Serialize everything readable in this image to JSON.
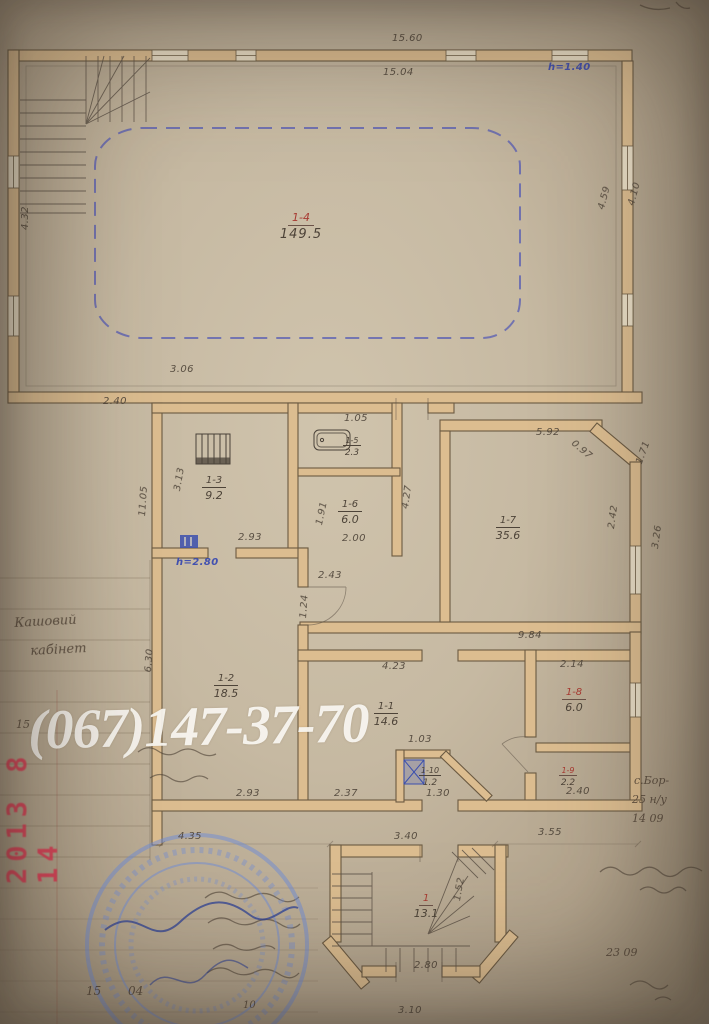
{
  "document": {
    "watermark_phone": "(067)147-37-70",
    "camera_date_stamp": "2013 8 14"
  },
  "plan": {
    "rooms": [
      {
        "id": "1-4",
        "num": "1-4",
        "area": "149.5",
        "x": 308,
        "y": 206,
        "red": true,
        "big": true
      },
      {
        "id": "1-3",
        "num": "1-3",
        "area": "9.2",
        "x": 214,
        "y": 468
      },
      {
        "id": "1-5",
        "num": "1-5",
        "area": "2.3",
        "x": 360,
        "y": 428,
        "small": true
      },
      {
        "id": "1-6",
        "num": "1-6",
        "area": "6.0",
        "x": 350,
        "y": 492
      },
      {
        "id": "1-7",
        "num": "1-7",
        "area": "35.6",
        "x": 508,
        "y": 508
      },
      {
        "id": "1-2",
        "num": "1-2",
        "area": "18.5",
        "x": 226,
        "y": 666
      },
      {
        "id": "1-1",
        "num": "1-1",
        "area": "14.6",
        "x": 386,
        "y": 694
      },
      {
        "id": "1-8",
        "num": "1-8",
        "area": "6.0",
        "x": 574,
        "y": 680,
        "red": true
      },
      {
        "id": "1-9",
        "num": "1-9",
        "area": "2.2",
        "x": 576,
        "y": 758,
        "red": true,
        "small": true
      },
      {
        "id": "1-10",
        "num": "1-10",
        "area": "1.2",
        "x": 438,
        "y": 758,
        "small": true
      },
      {
        "id": "1",
        "num": "1",
        "area": "13.1",
        "x": 426,
        "y": 886,
        "red": true
      }
    ],
    "dimensions": [
      {
        "t": "15.60",
        "x": 392,
        "y": 33
      },
      {
        "t": "15.04",
        "x": 383,
        "y": 67
      },
      {
        "t": "4.32",
        "x": 20,
        "y": 230,
        "r": -90
      },
      {
        "t": "4.59",
        "x": 596,
        "y": 208,
        "r": -75
      },
      {
        "t": "4.10",
        "x": 626,
        "y": 204,
        "r": -75
      },
      {
        "t": "3.06",
        "x": 170,
        "y": 364
      },
      {
        "t": "2.40",
        "x": 103,
        "y": 396
      },
      {
        "t": "1.05",
        "x": 344,
        "y": 413
      },
      {
        "t": "3.13",
        "x": 172,
        "y": 490,
        "r": -80
      },
      {
        "t": "11.05",
        "x": 137,
        "y": 516,
        "r": -86
      },
      {
        "t": "2.93",
        "x": 238,
        "y": 532
      },
      {
        "t": "1.91",
        "x": 314,
        "y": 524,
        "r": -78
      },
      {
        "t": "2.00",
        "x": 342,
        "y": 533
      },
      {
        "t": "4.27",
        "x": 400,
        "y": 508,
        "r": -82
      },
      {
        "t": "5.92",
        "x": 536,
        "y": 427
      },
      {
        "t": "0.97",
        "x": 576,
        "y": 438,
        "r": 40
      },
      {
        "t": "1.71",
        "x": 634,
        "y": 462,
        "r": -70
      },
      {
        "t": "2.42",
        "x": 606,
        "y": 528,
        "r": -82
      },
      {
        "t": "3.26",
        "x": 650,
        "y": 548,
        "r": -82
      },
      {
        "t": "9.84",
        "x": 518,
        "y": 630
      },
      {
        "t": "2.43",
        "x": 318,
        "y": 570
      },
      {
        "t": "1.24",
        "x": 298,
        "y": 618,
        "r": -86
      },
      {
        "t": "6.30",
        "x": 143,
        "y": 672,
        "r": -86
      },
      {
        "t": "4.23",
        "x": 382,
        "y": 661
      },
      {
        "t": "2.14",
        "x": 560,
        "y": 659
      },
      {
        "t": "1.03",
        "x": 408,
        "y": 734
      },
      {
        "t": "2.93",
        "x": 236,
        "y": 788
      },
      {
        "t": "2.37",
        "x": 334,
        "y": 788
      },
      {
        "t": "1.30",
        "x": 426,
        "y": 788
      },
      {
        "t": "2.40",
        "x": 566,
        "y": 786
      },
      {
        "t": "4.35",
        "x": 178,
        "y": 831
      },
      {
        "t": "3.40",
        "x": 394,
        "y": 831
      },
      {
        "t": "3.55",
        "x": 538,
        "y": 827
      },
      {
        "t": "1.52",
        "x": 452,
        "y": 900,
        "r": -80
      },
      {
        "t": "2.80",
        "x": 414,
        "y": 960
      },
      {
        "t": "3.10",
        "x": 398,
        "y": 1005
      }
    ],
    "height_notes": [
      {
        "t": "h=1.40",
        "x": 548,
        "y": 62
      },
      {
        "t": "h=2.80",
        "x": 176,
        "y": 557
      }
    ]
  },
  "margins": {
    "notes": [
      {
        "t": "Кашовий",
        "x": 14,
        "y": 616,
        "r": -3
      },
      {
        "t": "кабінет",
        "x": 30,
        "y": 644,
        "r": -3
      },
      {
        "t": "15",
        "x": 16,
        "y": 718,
        "s": 11
      },
      {
        "t": "15",
        "x": 86,
        "y": 984,
        "s": 12
      },
      {
        "t": "04",
        "x": 128,
        "y": 984,
        "s": 12
      },
      {
        "t": "10",
        "x": 243,
        "y": 1000,
        "s": 10
      },
      {
        "t": "с.Бор-",
        "x": 634,
        "y": 774,
        "s": 11
      },
      {
        "t": "25 н/у",
        "x": 632,
        "y": 793,
        "s": 11
      },
      {
        "t": "14 09",
        "x": 632,
        "y": 812,
        "s": 11
      },
      {
        "t": "23 09",
        "x": 606,
        "y": 946,
        "s": 11
      }
    ]
  }
}
